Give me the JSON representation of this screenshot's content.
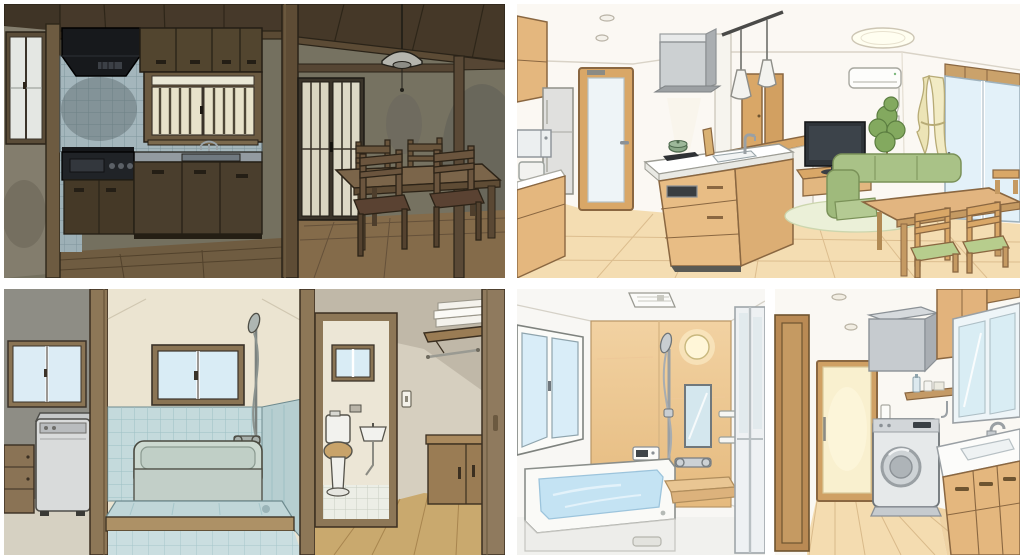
{
  "figure": {
    "title": "Japanese home interiors — four-panel renovation comparison illustration",
    "grid": {
      "rows": 2,
      "cols": 2,
      "gutter_color": "#ffffff"
    },
    "panels": [
      {
        "id": "old-kitchen-dining",
        "position": "top-left",
        "label": "Old dark kitchen with tiled backsplash and adjoining dining room",
        "style": "dated, dim lighting",
        "objects": [
          "small-window",
          "range-hood",
          "tile-backsplash",
          "upper-cabinets",
          "barred-window",
          "fluorescent-light",
          "faucet",
          "sink",
          "counter",
          "gas-stove",
          "lower-cabinets",
          "wood-post",
          "ceiling-beams",
          "sliding-glass-doors",
          "pendant-lamp",
          "pull-cord",
          "dining-table",
          "dining-chairs",
          "wood-floor",
          "wall-stains"
        ]
      },
      {
        "id": "modern-ldk",
        "position": "top-right",
        "label": "Renovated bright open-plan kitchen with living-dining area",
        "style": "modern, bright",
        "objects": [
          "downlights",
          "ceiling-light",
          "track-pendant-lights",
          "range-hood",
          "island-kitchen",
          "cooktop",
          "pot",
          "cutting-board",
          "sink",
          "faucet",
          "bar-counter",
          "refrigerator",
          "microwave",
          "toaster",
          "upper-cabinet",
          "base-cabinet",
          "frosted-door",
          "hall-doors",
          "air-conditioner",
          "television",
          "tv-stand",
          "potted-plant",
          "sofa",
          "curtain",
          "sliding-window",
          "rug",
          "dining-table",
          "dining-chairs",
          "wood-floor"
        ]
      },
      {
        "id": "old-bathroom",
        "position": "bottom-left",
        "label": "Old tiled bathroom with laundry corner, toilet room and hallway",
        "style": "dated, cold",
        "objects": [
          "laundry-window",
          "top-load-washer",
          "laundry-cabinet",
          "door-frame",
          "bath-window",
          "shower-head",
          "shower-hose",
          "mixer-valve",
          "bathtub",
          "tile-wainscot",
          "step-platform",
          "tile-floor",
          "toilet",
          "toilet-window",
          "wall-sink",
          "drain-pipe",
          "light-switch",
          "towel-shelf",
          "towels",
          "towel-bar",
          "low-cabinet",
          "sliding-door",
          "hall-wood-floor"
        ]
      },
      {
        "id": "modern-bathroom",
        "position": "bottom-right",
        "label": "Renovated unit bath with wood accent wall and laundry-vanity room",
        "style": "modern, bright",
        "objects": [
          "vent-fan",
          "wood-accent-wall",
          "round-wall-light",
          "bath-window",
          "grab-bar",
          "bathtub",
          "bath-water",
          "hand-shower",
          "slide-bar",
          "shower-hose",
          "mixer-valve",
          "mirror",
          "wall-shelves",
          "control-panel",
          "bench",
          "floor-drain",
          "glass-door",
          "downlights",
          "open-door-frame",
          "frosted-door",
          "duct-box",
          "wall-cabinet",
          "shelf-with-bottles",
          "drum-washer",
          "washer-pedestal",
          "mirror-cabinet",
          "vanity-counter",
          "vanity-sink",
          "faucet",
          "vanity-cabinets",
          "wood-floor"
        ]
      }
    ]
  },
  "palette": {
    "gutter_white": "#ffffff",
    "old_wall_olive": "#74705f",
    "old_wood_dark": "#5e4c35",
    "old_ceiling": "#46392a",
    "old_tile_blue": "#a4b6bc",
    "old_cabinet_brown": "#52452f",
    "hood_black": "#17191c",
    "frosted_glass_warm": "#e7e2ca",
    "old_floor_brown": "#6f5c41",
    "new_wall_white": "#fbf8f3",
    "new_wood_light": "#e4b77e",
    "new_wood_frame": "#8a6741",
    "new_floor_wood": "#f4ddb2",
    "sofa_green": "#a9c287",
    "cushion_green": "#b7cd8d",
    "curtain_cream": "#ece4b6",
    "glass_blue": "#dcecf5",
    "bath_tile_old": "#c4dadc",
    "bath_tub_old": "#ccd9d0",
    "accent_wood_top": "#f2d2a2",
    "accent_wood_bottom": "#e5ba7e",
    "bath_water_blue": "#c4e3f3",
    "appliance_grey": "#d9dbdb",
    "steel_grey": "#c6cbcf"
  }
}
